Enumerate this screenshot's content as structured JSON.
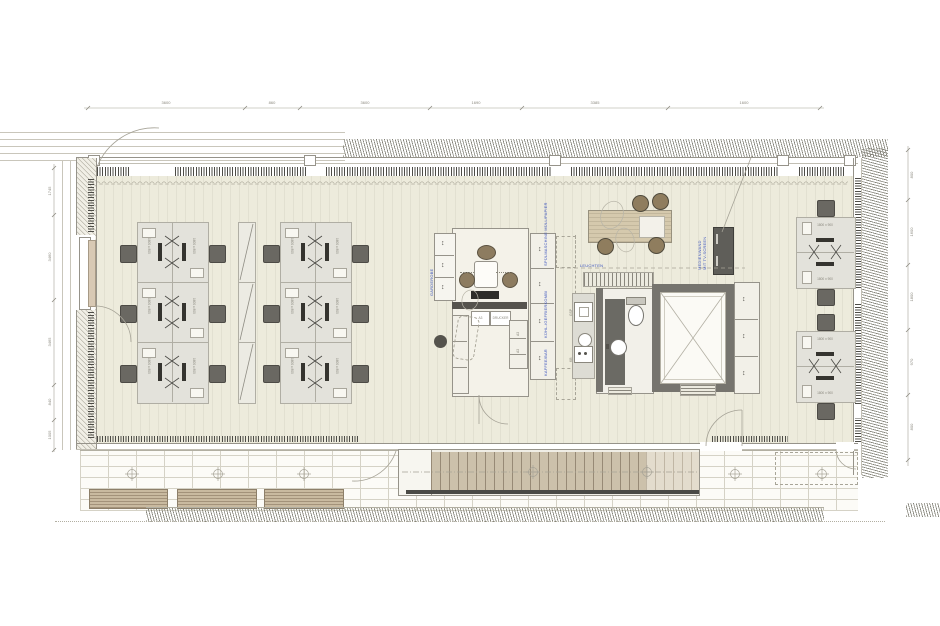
{
  "dims": {
    "top": [
      "3600",
      "860",
      "3600",
      "1690",
      "3385",
      "1600"
    ],
    "left": [
      "1745",
      "3460",
      "3465",
      "840",
      "1005"
    ],
    "right": [
      "800",
      "1600",
      "1800",
      "970",
      "800"
    ]
  },
  "labels": {
    "desk_size_v": "1600 x 800",
    "desk_size_h": "1800 x 900",
    "a3": "A3",
    "printer": "DRUCKER",
    "wardrobe": "GARDEROBE",
    "kitchen_unit_1": "SPÜLMASCHINE MÜLL/PAPIER",
    "kitchen_unit_2": "KÜHL-/GEFRIERKOMBI",
    "kitchen_unit_3": "KAFFEE/BAR",
    "lights": "LEUCHTEN",
    "media_wall_line1": "MEDIENWAND",
    "media_wall_line2": "MIT TV-SCREEN",
    "dishwasher": "GSP",
    "hob": "KB"
  },
  "colors": {
    "floor": "#edebdc",
    "wall_dark": "#76746e",
    "annotation_blue": "#3b53bd",
    "wood": "#ccc1ab",
    "furniture_gray": "#e3e2db"
  }
}
